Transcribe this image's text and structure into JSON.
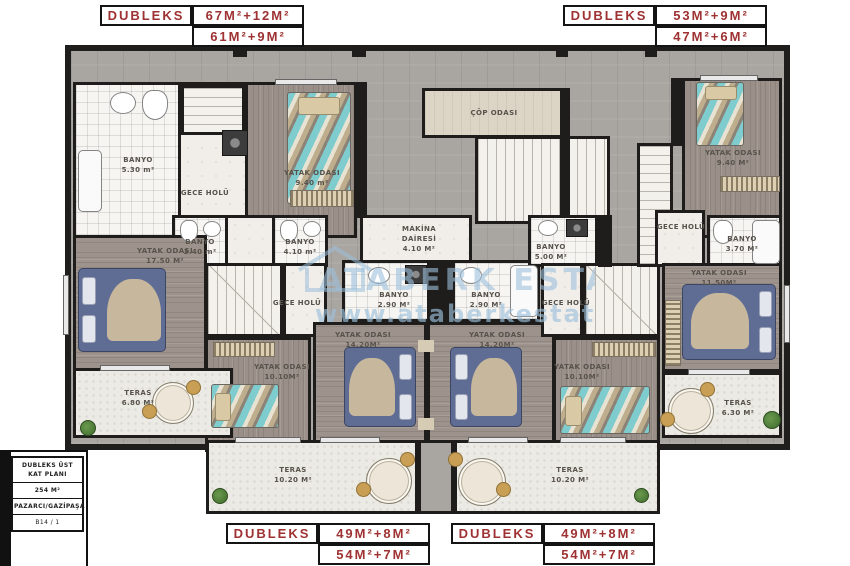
{
  "meta": {
    "accent_color": "#9e3132",
    "watermark_color": "#9cc0dc"
  },
  "badges": {
    "top_left": {
      "title": "DUBLEKS",
      "line1": "67M²+12M²",
      "line2": "61M²+9M²"
    },
    "top_right": {
      "title": "DUBLEKS",
      "line1": "53M²+9M²",
      "line2": "47M²+6M²"
    },
    "bottom_left": {
      "title": "DUBLEKS",
      "line1": "49M²+8M²",
      "line2": "54M²+7M²"
    },
    "bottom_right": {
      "title": "DUBLEKS",
      "line1": "49M²+8M²",
      "line2": "54M²+7M²"
    }
  },
  "title_block": {
    "plan_title": "DUBLEKS ÜST KAT PLANI",
    "total_area": "254 M²",
    "location": "PAZARCI/GAZİPAŞA",
    "unit_no": "B14 / 1"
  },
  "watermark": {
    "brand": "ATABERK ESTATE",
    "url": "www.ataberkestate.com"
  },
  "rooms": {
    "banyo_530": {
      "name": "BANYO",
      "area": "5.30 m²"
    },
    "gece_holu_tl": {
      "name": "GECE HOLÜ"
    },
    "yatak_940_l": {
      "name": "YATAK ODASI",
      "area": "9.40 m²"
    },
    "banyo_340": {
      "name": "BANYO",
      "area": "3.40 m²"
    },
    "banyo_410": {
      "name": "BANYO",
      "area": "4.10 m²"
    },
    "yatak_1750": {
      "name": "YATAK ODASI",
      "area": "17.50 M²"
    },
    "gece_holu_l": {
      "name": "GECE HOLÜ"
    },
    "yatak_1010_l": {
      "name": "YATAK ODASI",
      "area": "10.10M²"
    },
    "teras_680": {
      "name": "TERAS",
      "area": "6.80 M²"
    },
    "cop_odasi": {
      "name": "ÇÖP ODASI"
    },
    "makina": {
      "name": "MAKİNA DAİRESİ",
      "area": "4.10 M²"
    },
    "banyo_290_l": {
      "name": "BANYO",
      "area": "2.90 M²"
    },
    "banyo_290_r": {
      "name": "BANYO",
      "area": "2.90 M²"
    },
    "banyo_500": {
      "name": "BANYO",
      "area": "5.00 M²"
    },
    "yatak_1420_l": {
      "name": "YATAK ODASI",
      "area": "14.20M²"
    },
    "yatak_1420_r": {
      "name": "YATAK ODASI",
      "area": "14.20M²"
    },
    "gece_holu_r": {
      "name": "GECE HOLÜ"
    },
    "yatak_1010_r": {
      "name": "YATAK ODASI",
      "area": "10.10M²"
    },
    "yatak_940_r": {
      "name": "YATAK ODASI",
      "area": "9.40 M²"
    },
    "gece_holu_tr": {
      "name": "GECE HOLÜ"
    },
    "banyo_370": {
      "name": "BANYO",
      "area": "3.70 M²"
    },
    "yatak_1150": {
      "name": "YATAK ODASI",
      "area": "11.50M²"
    },
    "teras_630": {
      "name": "TERAS",
      "area": "6.30 M²"
    },
    "teras_1020_l": {
      "name": "TERAS",
      "area": "10.20 M²"
    },
    "teras_1020_r": {
      "name": "TERAS",
      "area": "10.20 M²"
    }
  }
}
